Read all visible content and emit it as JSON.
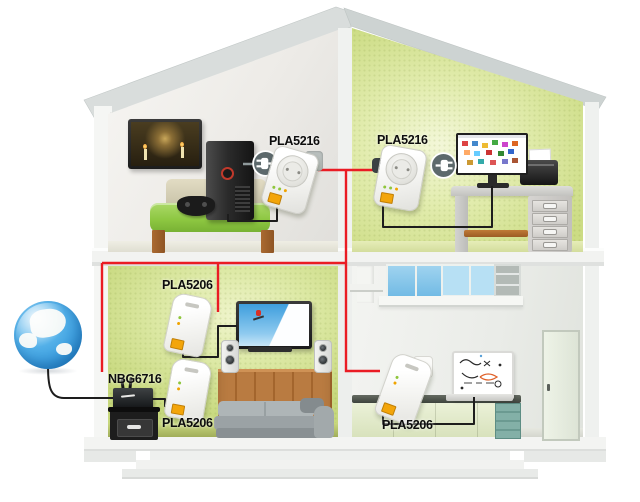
{
  "devices": {
    "pla5216_upper_left": {
      "label": "PLA5216"
    },
    "pla5216_upper_right": {
      "label": "PLA5216"
    },
    "pla5206_living_tv": {
      "label": "PLA5206"
    },
    "pla5206_living_router": {
      "label": "PLA5206"
    },
    "router_nbg6716": {
      "label": "NBG6716"
    },
    "pla5206_kitchen": {
      "label": "PLA5206"
    }
  },
  "icons": {
    "power_plug_upper_left": "power-plug",
    "power_plug_upper_right": "power-plug",
    "internet_globe": "internet-globe"
  },
  "colors": {
    "powerline_link_red": "#ea1c24",
    "ethernet_cable_black": "#1d1d1d",
    "adapter_port_yellow": "#f3a50a",
    "globe_ocean_blue": "#3fa3e4",
    "wall_green": "#cdde86",
    "label_text": "#0d0d0d"
  }
}
